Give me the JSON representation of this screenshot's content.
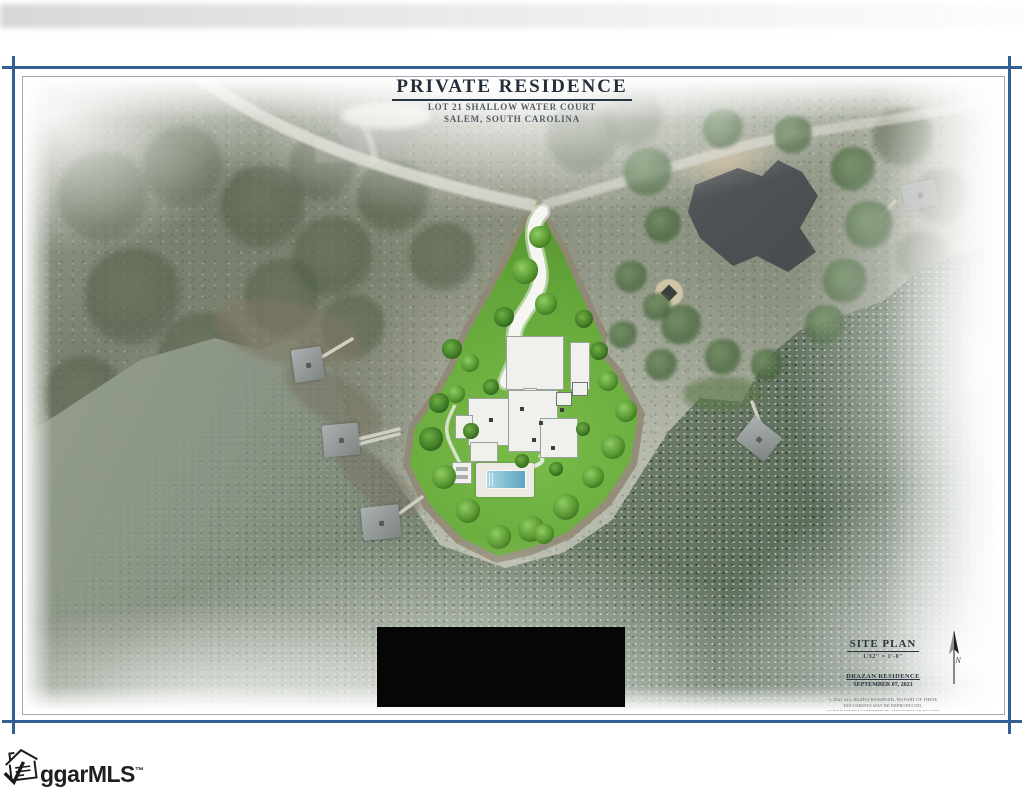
{
  "document": {
    "header": {
      "title": "PRIVATE RESIDENCE",
      "address_line1": "LOT 21 SHALLOW WATER COURT",
      "address_line2": "SALEM, SOUTH CAROLINA"
    },
    "title_block": {
      "drawing_title": "SITE PLAN",
      "scale": "1/32\" = 1'-0\"",
      "project_name": "DRAZAN RESIDENCE",
      "project_date": "SEPTEMBER 07, 2021",
      "disclaimer_lines": [
        "© 2021 ALL RIGHTS RESERVED. NO PART OF THESE DOCUMENTS MAY BE REPRODUCED,",
        "COPIED OR TRANSMITTED IN ANY FORM OR BY ANY MEANS, INCLUDING PHOTOCOPYING,",
        "RECORDING, OR OTHER ELECTRONIC OR MECHANICAL METHODS, WITHOUT THE PRIOR",
        "WRITTEN PERMISSION OF THE ARCHITECT. DRAWINGS ARE FOR ILLUSTRATIVE",
        "PURPOSES ONLY AND ARE SUBJECT TO CHANGE WITHOUT NOTICE."
      ]
    },
    "north_arrow_label": "N",
    "watermark": {
      "brand_text": "ggarMLS",
      "trademark_symbol": "™"
    }
  },
  "colors": {
    "frame_blue": "#2f5f93",
    "inner_frame_line": "#9fa8b4",
    "title_ink": "#242e3a",
    "lot_green": "#63a438",
    "tree_green": "#3f7a24",
    "water_gray_green": "#7e8a79",
    "water_dark": "#4d5e50",
    "pool_blue": "#5fa3c0",
    "neighbor_roof_gray": "#474b4e",
    "redaction_black": "#060606"
  }
}
